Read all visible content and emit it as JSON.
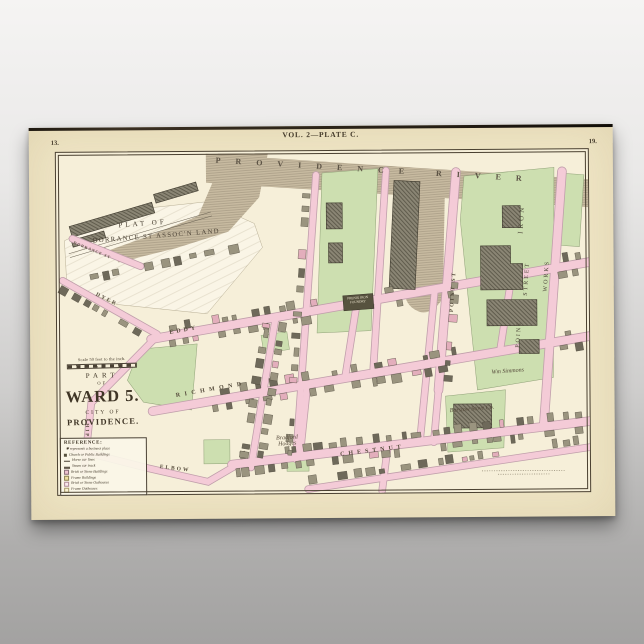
{
  "poster": {
    "plate_title": "VOL. 2—PLATE C.",
    "page_number_left": "13.",
    "page_number_right": "19.",
    "map": {
      "river_label": "PROVIDENCE RIVER",
      "plat_label_line1": "PLAT OF",
      "plat_label_line2": "DORRANCE ST ASSOC'N LAND",
      "streets": {
        "eddy": "EDDY",
        "richmond": "RICHMOND",
        "chestnut": "CHESTNUT",
        "elbow": "ELBOW",
        "ship": "SHIP",
        "dyer": "DYER",
        "dorrance": "DORRANCE ST",
        "point": "POINT ST"
      },
      "places": {
        "iron_works_word1": "IRON",
        "iron_works_word2": "STREET",
        "iron_works_word3": "WORKS",
        "iron_works_word4": "POINT",
        "phenix": "PHENIX IRON FOUNDRY",
        "barstow": "Barstow Stove Co.",
        "simmons": "Wm Simmons",
        "hodges_line1": "Bradford",
        "hodges_line2": "Hodges"
      },
      "title_block": {
        "part": "PART",
        "of": "OF",
        "ward": "WARD 5.",
        "city_of": "CITY OF",
        "city": "PROVIDENCE."
      },
      "scale_text": "Scale 50 feet to the inch.",
      "reference": {
        "heading": "REFERENCE:",
        "items": [
          "✱ represents a business place",
          "Church or Public Buildings",
          "Horse car lines",
          "Steam car track",
          "Brick or Stone Buildings",
          "Frame Buildings",
          "Brick or Stone Outhouses",
          "Frame Outhouses"
        ]
      },
      "colors": {
        "paper": "#efe5c5",
        "map_ground": "#f6efd9",
        "street_pink": "#f4cbd7",
        "block_green": "#cddfb0",
        "water_tan": "#c7baa0",
        "building_gray": "#9a947f",
        "ink": "#4a4134"
      }
    }
  }
}
